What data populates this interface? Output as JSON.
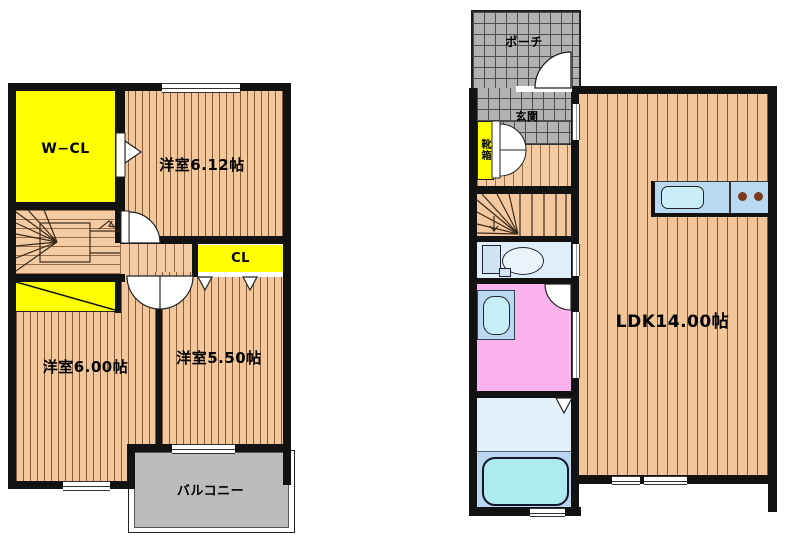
{
  "document": {
    "type": "floor-plan",
    "background": "#ffffff"
  },
  "colors": {
    "wall": "#121212",
    "wood_floor": "#f3c79c",
    "wood_stripe": "#8a5a38",
    "closet_yellow": "#ffff00",
    "porch_gray": "#b2b2b2",
    "balcony_gray": "#bcbcbc",
    "toilet_room_blue": "#dfeef8",
    "washroom_pink": "#fbb3f0",
    "bathroom_light_blue": "#e3f0fa",
    "bathroom_deep_blue": "#bad5ef",
    "bathtub_cyan": "#aeeaf2",
    "kitchen_counter_blue": "#b9d9f0",
    "kitchen_sink_cyan": "#c9eef8",
    "burner_brown": "#7a3a1d"
  },
  "floor2": {
    "rooms": {
      "wcl": {
        "label": "W−CL"
      },
      "bed1": {
        "label": "洋室6.12帖"
      },
      "cl": {
        "label": "CL"
      },
      "bed2": {
        "label": "洋室6.00帖"
      },
      "bed3": {
        "label": "洋室5.50帖"
      },
      "balcony": {
        "label": "バルコニー"
      }
    }
  },
  "floor1": {
    "rooms": {
      "porch": {
        "label": "ポーチ"
      },
      "entrance": {
        "label": "玄関"
      },
      "shoebox": {
        "label": "靴箱"
      },
      "ldk": {
        "label": "LDK14.00帖"
      }
    }
  }
}
